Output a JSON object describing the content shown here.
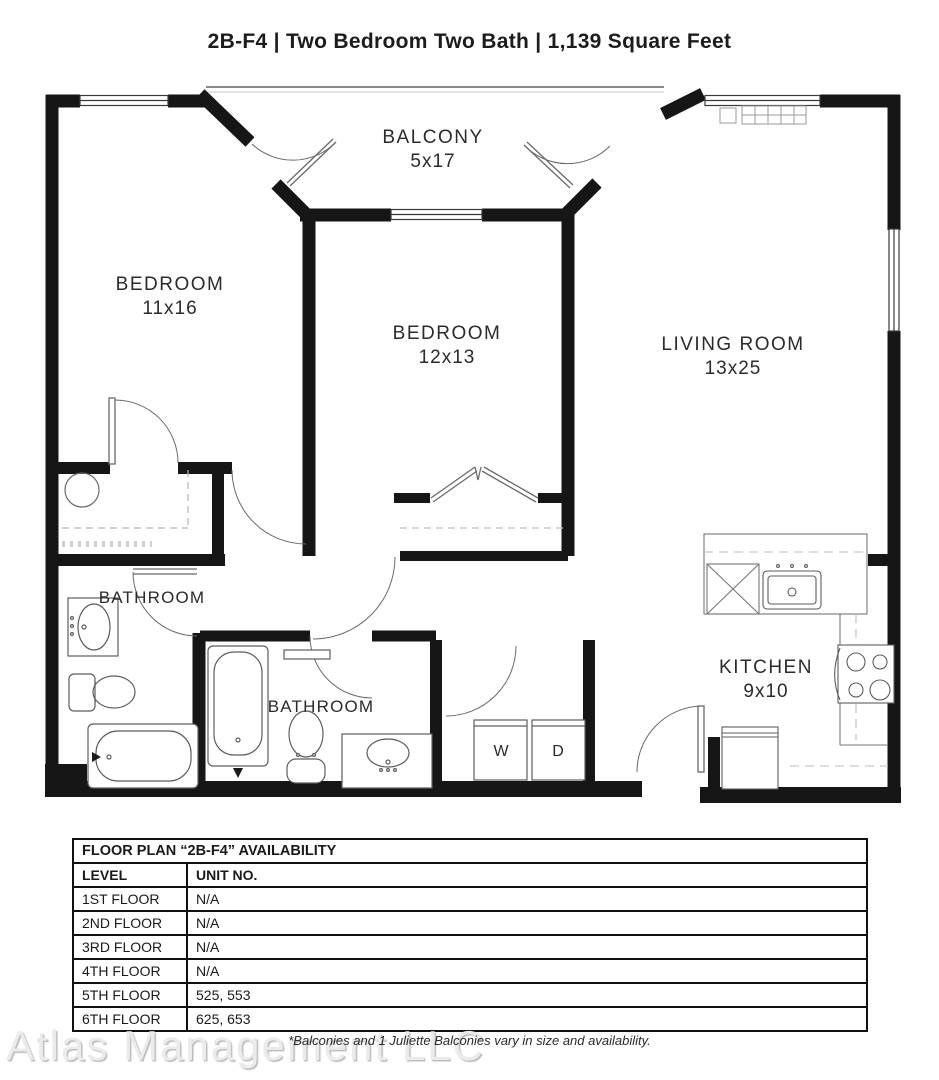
{
  "title": "2B-F4 | Two Bedroom Two Bath | 1,139 Square Feet",
  "floor_plan": {
    "rooms": [
      {
        "label": "BALCONY",
        "dims": "5x17"
      },
      {
        "label": "BEDROOM",
        "dims": "11x16"
      },
      {
        "label": "BEDROOM",
        "dims": "12x13"
      },
      {
        "label": "LIVING ROOM",
        "dims": "13x25"
      },
      {
        "label": "BATHROOM"
      },
      {
        "label": "BATHROOM"
      },
      {
        "label": "KITCHEN",
        "dims": "9x10"
      }
    ],
    "washer_label": "W",
    "dryer_label": "D"
  },
  "availability_table": {
    "title": "FLOOR PLAN “2B-F4” AVAILABILITY",
    "columns": [
      "LEVEL",
      "UNIT NO."
    ],
    "rows": [
      [
        "1ST FLOOR",
        "N/A"
      ],
      [
        "2ND FLOOR",
        "N/A"
      ],
      [
        "3RD FLOOR",
        "N/A"
      ],
      [
        "4TH FLOOR",
        "N/A"
      ],
      [
        "5TH FLOOR",
        "525, 553"
      ],
      [
        "6TH FLOOR",
        "625, 653"
      ]
    ]
  },
  "footer": {
    "watermark": "Atlas Management LLC",
    "disclaimer": "*Balconies and 1 Juliette Balconies vary in size and availability."
  }
}
